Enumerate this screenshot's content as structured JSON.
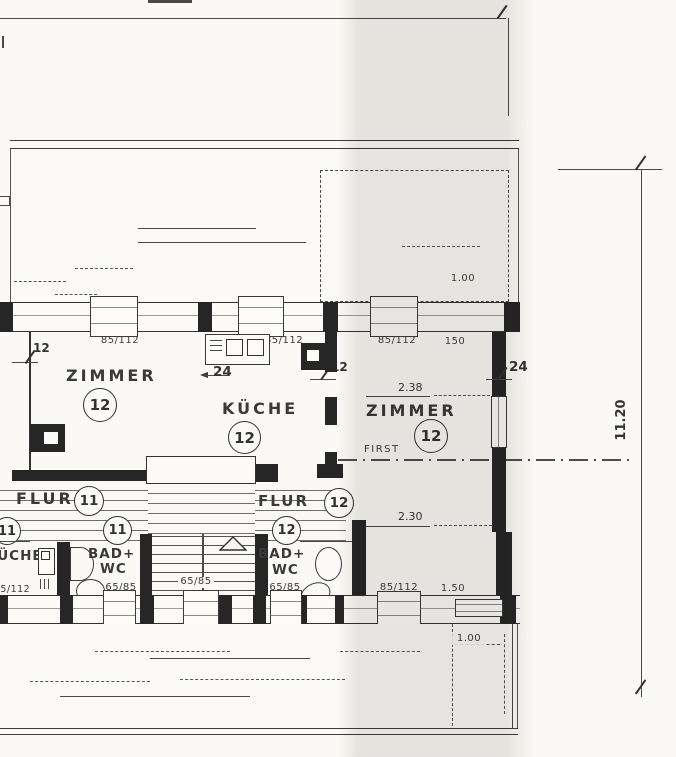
{
  "plan": {
    "colors": {
      "ink": "#3a3a3a",
      "wall_fill": "#262626",
      "paper": "#faf9f5",
      "scan_band": "#d9d6d0"
    },
    "rooms": {
      "zimmer_left": {
        "label": "ZIMMER",
        "number": "12"
      },
      "kueche": {
        "label": "KÜCHE",
        "number": "12"
      },
      "zimmer_right": {
        "label": "ZIMMER",
        "number": "12"
      },
      "flur_11": {
        "label": "FLUR",
        "number": "11"
      },
      "flur_12": {
        "label": "FLUR",
        "number": "12"
      },
      "kueche_11": {
        "label": "KÜCHE"
      },
      "bad_wc_left": {
        "line1": "BAD+",
        "line2": "WC"
      },
      "bad_wc_right": {
        "line1": "BAD+",
        "line2": "WC"
      },
      "badge_11_left": "11",
      "badge_11_right": "11",
      "badge_12_bath": "12"
    },
    "openings": {
      "top_win_1": "85/112",
      "top_win_2": "85/112",
      "top_win_3": "85/112",
      "top_win_4": "150",
      "bottom_win_left": "85/112",
      "bottom_win_bath_left": "65/85",
      "bottom_win_stairs": "65/85",
      "bottom_win_bath_right": "65/85",
      "bottom_win_zimmer": "85/112",
      "bottom_win_right": "1.50"
    },
    "dimensions": {
      "wall_left": "12",
      "pier_kueche": "24",
      "flue": "12",
      "wall_right": "24",
      "room_width_top": "2.38",
      "room_width_bottom": "2.30",
      "ridge": "FIRST",
      "total_height": "11.20",
      "roof_top": "1.00",
      "roof_bottom": "1.00"
    }
  }
}
